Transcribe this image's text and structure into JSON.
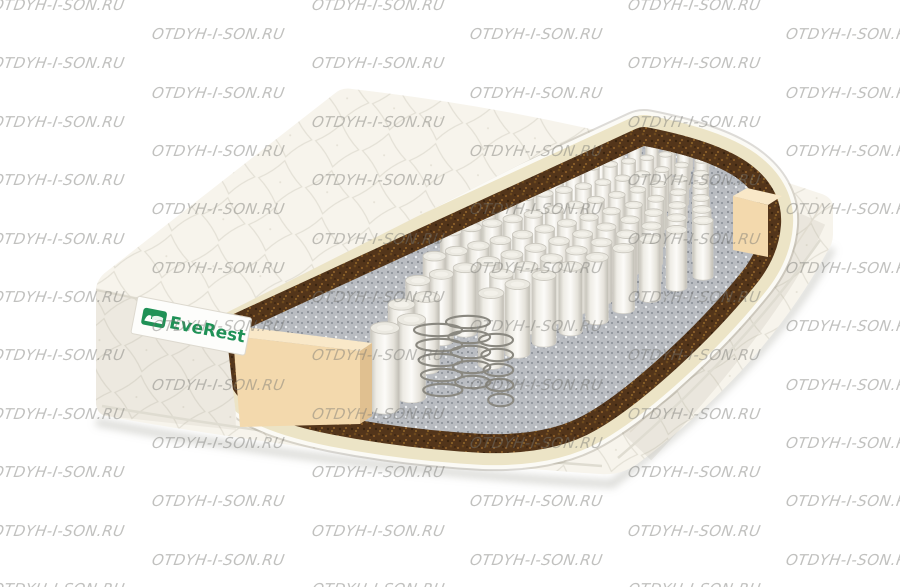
{
  "watermark": {
    "text": "OTDYH-I-SON.RU",
    "color": "rgba(118,118,112,0.45)"
  },
  "mattress": {
    "brand_label": {
      "text": "EveRest",
      "text_color": "#1f9156",
      "background": "#fdfdfb",
      "icon": "bed-icon"
    },
    "colors": {
      "background": "#ffffff",
      "cover": "#f7f4ec",
      "cover_side_shade": "rgba(170,162,145,0.13)",
      "quilt_line": "#d3cfc2",
      "piping": "#fbfaf5",
      "foam": "#ece4c6",
      "coir": "#53351a",
      "felt": "#b9bcc1",
      "spring_fabric": "#f2f0ea",
      "spring_top": "#ebe9e1",
      "edge_foam": "#f3d9ad",
      "edge_foam_top": "#f9e8c8",
      "edge_foam_side": "#e0c090",
      "wire": "#8a8880",
      "shadow": "rgba(150,148,140,0.35)"
    }
  }
}
